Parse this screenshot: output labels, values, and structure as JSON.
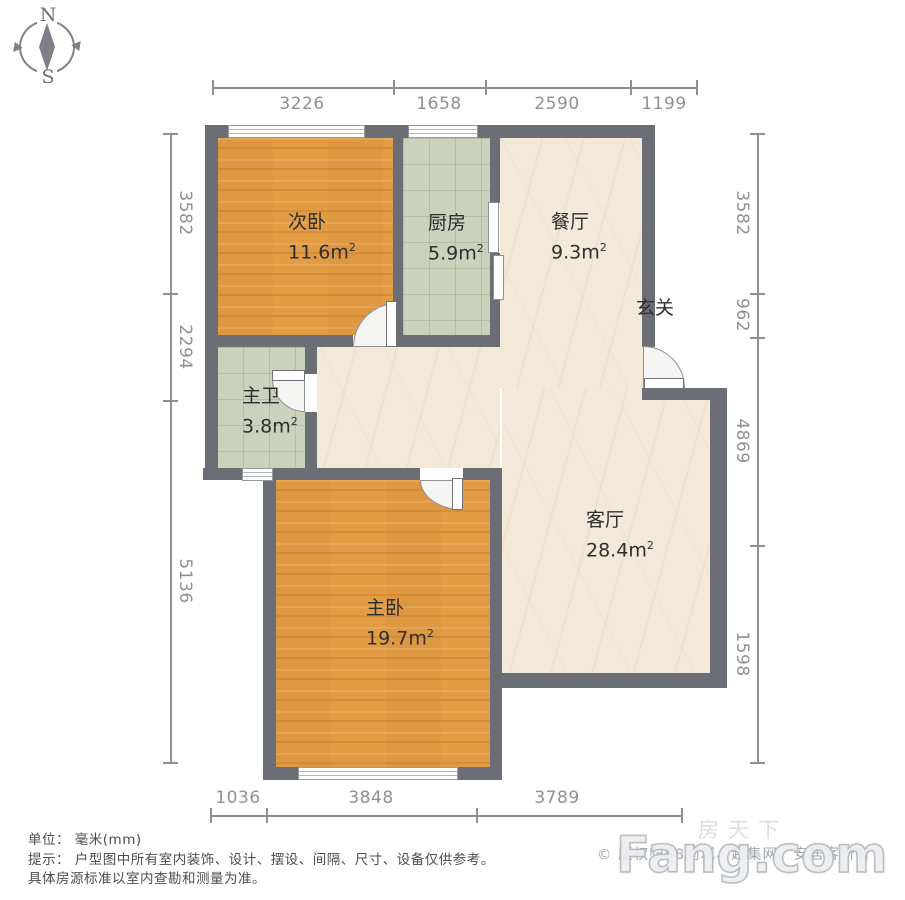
{
  "compass": {
    "north": "N",
    "south": "S"
  },
  "dimensions": {
    "unit_note": "毫米(mm)",
    "top": {
      "labels": [
        "3226",
        "1658",
        "2590",
        "1199"
      ]
    },
    "left": {
      "labels": [
        "3582",
        "2294",
        "5136"
      ]
    },
    "right": {
      "labels": [
        "3582",
        "962",
        "4869",
        "1598"
      ]
    },
    "bottom": {
      "labels": [
        "1036",
        "3848",
        "3789"
      ]
    }
  },
  "rooms": {
    "bedroom2": {
      "name": "次卧",
      "area": "11.6",
      "unit": "m",
      "exp": "2"
    },
    "kitchen": {
      "name": "厨房",
      "area": "5.9",
      "unit": "m",
      "exp": "2"
    },
    "dining": {
      "name": "餐厅",
      "area": "9.3",
      "unit": "m",
      "exp": "2"
    },
    "entry": {
      "name": "玄关"
    },
    "bath": {
      "name": "主卫",
      "area": "3.8",
      "unit": "m",
      "exp": "2"
    },
    "living": {
      "name": "客厅",
      "area": "28.4",
      "unit": "m",
      "exp": "2"
    },
    "bedroom1": {
      "name": "主卧",
      "area": "19.7",
      "unit": "m",
      "exp": "2"
    }
  },
  "footer": {
    "unit_line": "单位： 毫米(mm)",
    "tip_line1": "提示： 户型图中所有室内装饰、设计、摆设、间隔、尺寸、设备仅供参考。",
    "tip_line2": "具体房源标准以室内查勘和测量为准。",
    "copyright": "© 版权归58同城、赶集网、安居客所有",
    "watermark_cn": "房天下",
    "watermark_en": "Fang.com"
  },
  "colors": {
    "wall": "#6b6e74",
    "wood": "#e29c44",
    "tile": "#cbd2bc",
    "marble": "#f2e9d8",
    "dim": "#8d9196",
    "label": "#2e2e2e",
    "footer": "#4d4d4d",
    "copyright": "#a0a4a8",
    "watermark": "#d9dce0"
  }
}
